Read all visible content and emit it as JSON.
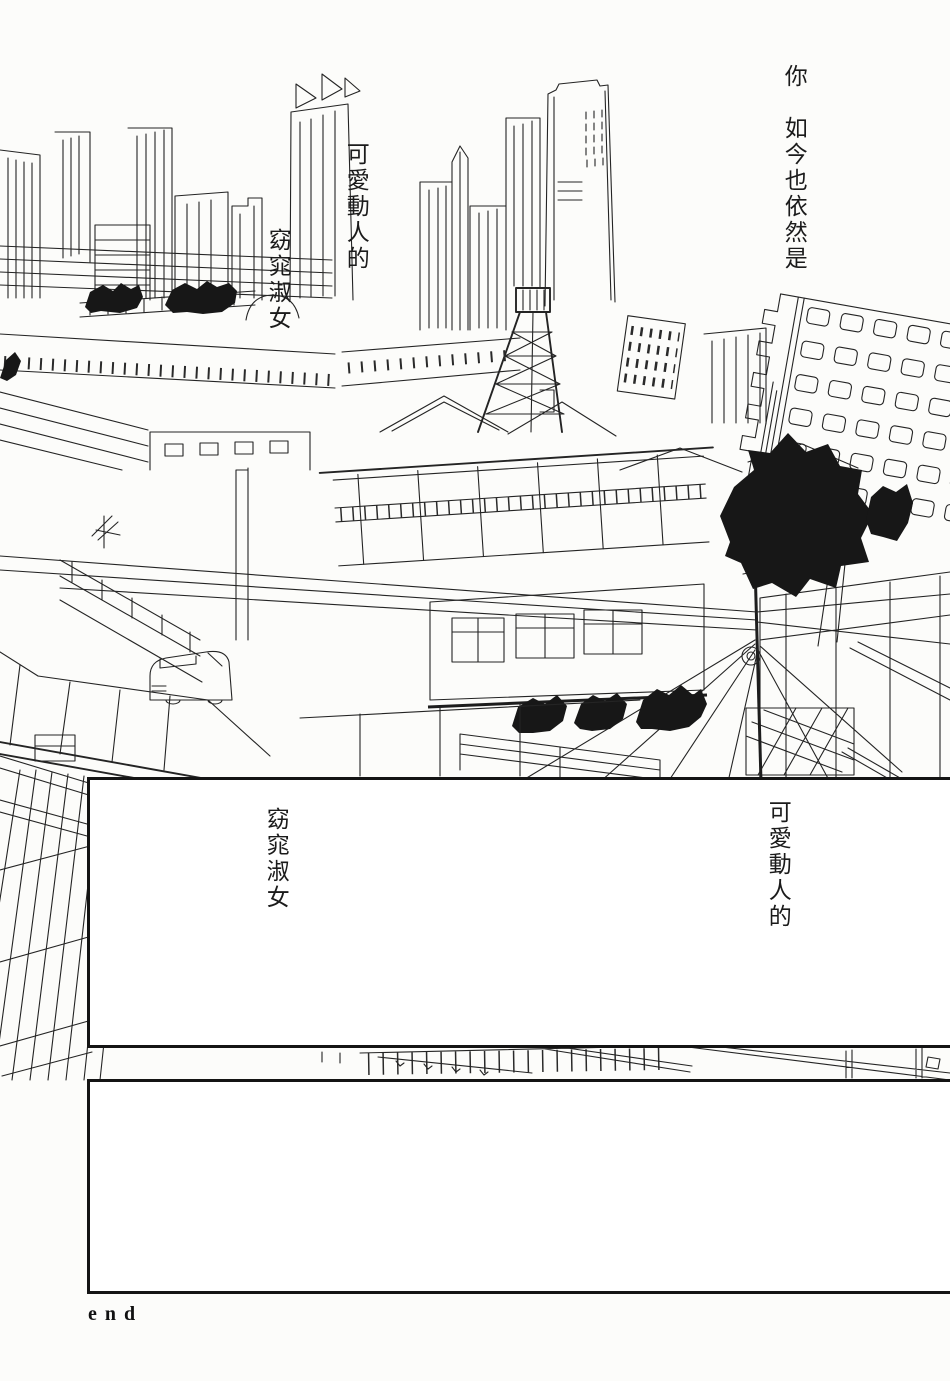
{
  "captions": {
    "top_right": "你　如今也依然是",
    "top_cute": "可愛動人的",
    "top_lady": "窈窕淑女",
    "panel_left": "窈窕淑女",
    "panel_right": "可愛動人的",
    "end_label": "end"
  },
  "artwork": {
    "label": "cityscape-line-art"
  },
  "colors": {
    "paper": "#fcfcfa",
    "ink": "#242424",
    "panel_bg": "#ffffff",
    "panel_border": "#141414",
    "foliage": "#171717"
  }
}
